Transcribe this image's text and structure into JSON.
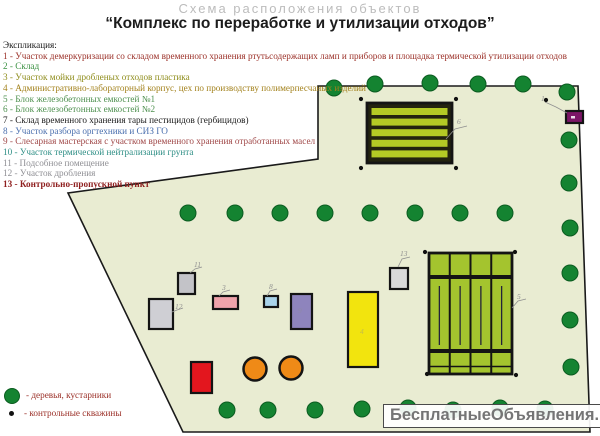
{
  "header": {
    "watermark_title": "Схема расположения объектов",
    "title": "“Комплекс по переработке и утилизации отходов”"
  },
  "legend": {
    "heading": "Экспликация:",
    "items": [
      {
        "num": "1",
        "text": "1 - Участок демеркуризации со складом временного хранения ртутьсодержащих ламп и приборов и площадка термической утилизации отходов",
        "color": "#9b3028"
      },
      {
        "num": "2",
        "text": "2 - Склад",
        "color": "#3a9142"
      },
      {
        "num": "3",
        "text": "3 - Участок мойки дробленых отходов пластика",
        "color": "#8f8d1c"
      },
      {
        "num": "4",
        "text": "4 - Административно-лабораторный корпус, цех по производству полимерпесчаных изделий",
        "color": "#a3821d"
      },
      {
        "num": "5",
        "text": "5 - Блок железобетонных емкостей №1",
        "color": "#4f9150"
      },
      {
        "num": "6",
        "text": "6 - Блок железобетонных емкостей №2",
        "color": "#4f9150"
      },
      {
        "num": "7",
        "text": "7 - Склад временного хранения тары пестицидов (гербицидов)",
        "color": "#1a1a1a"
      },
      {
        "num": "8",
        "text": "8 - Участок разбора оргтехники и СИЗ ГО",
        "color": "#4a6fae"
      },
      {
        "num": "9",
        "text": "9 - Слесарная мастерская с участком временного хранения отработанных масел",
        "color": "#a04848"
      },
      {
        "num": "10",
        "text": "10 - Участок термической нейтрализации грунта",
        "color": "#2f8f86"
      },
      {
        "num": "11",
        "text": "11 - Подсобное помещение",
        "color": "#8f8f94"
      },
      {
        "num": "12",
        "text": "12 - Участок дробления",
        "color": "#8f8f94"
      },
      {
        "num": "13",
        "text": "13 - Контрольно-пропускной пункт",
        "color": "#8f1f1f",
        "bold": true
      }
    ]
  },
  "symbols": [
    {
      "icon": "tree-icon",
      "label": "- деревья, кустарники"
    },
    {
      "icon": "well-icon",
      "label": "- контрольные скважины"
    }
  ],
  "watermark": "БесплатныеОбъявления.рф",
  "colors": {
    "site_fill": "#e9ecd2",
    "site_border": "#1a1a1a",
    "tree": "#148331",
    "tree_edge": "#0b5c20",
    "well": "#111111",
    "marker_label": "#8f8f8f"
  },
  "map": {
    "boundary": "318,86 578,86 590,432 183,432 68,193 318,159",
    "trees": [
      [
        334,
        88
      ],
      [
        375,
        84
      ],
      [
        430,
        83
      ],
      [
        478,
        84
      ],
      [
        523,
        84
      ],
      [
        567,
        92
      ],
      [
        569,
        140
      ],
      [
        569,
        183
      ],
      [
        570,
        228
      ],
      [
        570,
        273
      ],
      [
        570,
        320
      ],
      [
        571,
        367
      ],
      [
        188,
        213
      ],
      [
        235,
        213
      ],
      [
        280,
        213
      ],
      [
        325,
        213
      ],
      [
        370,
        213
      ],
      [
        415,
        213
      ],
      [
        460,
        213
      ],
      [
        505,
        213
      ],
      [
        227,
        410
      ],
      [
        268,
        410
      ],
      [
        315,
        410
      ],
      [
        362,
        409
      ],
      [
        408,
        408
      ],
      [
        453,
        410
      ],
      [
        500,
        408
      ],
      [
        545,
        409
      ]
    ],
    "wells": [
      [
        361,
        99
      ],
      [
        456,
        99
      ],
      [
        361,
        168
      ],
      [
        456,
        168
      ],
      [
        425,
        252
      ],
      [
        515,
        252
      ],
      [
        427,
        374
      ],
      [
        516,
        375
      ],
      [
        546,
        100
      ]
    ],
    "buildings": [
      {
        "id": "b6",
        "type": "striped",
        "x": 367,
        "y": 103,
        "w": 85,
        "h": 60,
        "fill": "#23230f",
        "stripe": "#b4ca25"
      },
      {
        "id": "b5",
        "type": "grid",
        "x": 429,
        "y": 253,
        "w": 83,
        "h": 121,
        "fill": "#a4c42e"
      },
      {
        "id": "b13",
        "type": "rect",
        "x": 390,
        "y": 268,
        "w": 18,
        "h": 21,
        "fill": "#d9d9d9"
      },
      {
        "id": "b4",
        "type": "rect",
        "x": 348,
        "y": 292,
        "w": 30,
        "h": 75,
        "fill": "#f2e40e"
      },
      {
        "id": "b9",
        "type": "rect",
        "x": 291,
        "y": 294,
        "w": 21,
        "h": 35,
        "fill": "#8e84bd"
      },
      {
        "id": "b8",
        "type": "rect",
        "x": 264,
        "y": 296,
        "w": 14,
        "h": 11,
        "fill": "#a9d3ea"
      },
      {
        "id": "b3",
        "type": "rect",
        "x": 213,
        "y": 296,
        "w": 25,
        "h": 13,
        "fill": "#efa3ab"
      },
      {
        "id": "b11",
        "type": "rect",
        "x": 178,
        "y": 273,
        "w": 17,
        "h": 21,
        "fill": "#c3c3c8"
      },
      {
        "id": "b12",
        "type": "rect",
        "x": 149,
        "y": 299,
        "w": 24,
        "h": 30,
        "fill": "#cfcfd4"
      },
      {
        "id": "b-red",
        "type": "rect",
        "x": 191,
        "y": 362,
        "w": 21,
        "h": 31,
        "fill": "#e3161e"
      },
      {
        "id": "b1",
        "type": "rect",
        "x": 566,
        "y": 111,
        "w": 17,
        "h": 12,
        "fill": "#7c1566"
      },
      {
        "id": "tank1",
        "type": "circle",
        "cx": 255,
        "cy": 369,
        "r": 11.5,
        "fill": "#ef8a17"
      },
      {
        "id": "tank2",
        "type": "circle",
        "cx": 291,
        "cy": 368,
        "r": 11.5,
        "fill": "#ef8a17"
      }
    ],
    "markers": [
      {
        "label": "6",
        "x": 457,
        "y": 124,
        "leader": "446,139 455,129 467,126"
      },
      {
        "label": "5",
        "x": 517,
        "y": 299,
        "leader": "512,308 518,301 526,299"
      },
      {
        "label": "13",
        "x": 400,
        "y": 256,
        "leader": "398,267 402,259 410,257"
      },
      {
        "label": "11",
        "x": 194,
        "y": 267,
        "leader": "190,273 195,269 202,267"
      },
      {
        "label": "12",
        "x": 175,
        "y": 309,
        "leader": "172,312 177,310 183,308"
      },
      {
        "label": "3",
        "x": 222,
        "y": 290,
        "leader": "219,296 223,292 230,290"
      },
      {
        "label": "8",
        "x": 269,
        "y": 289,
        "leader": "267,296 270,291 277,289"
      },
      {
        "label": "1",
        "x": 541,
        "y": 101,
        "leader": "545,102 556,107 567,113"
      },
      {
        "label": "4",
        "x": 360,
        "y": 334,
        "leader": "",
        "faint": true
      },
      {
        "label": "9",
        "x": 298,
        "y": 313,
        "leader": "",
        "faint": true
      }
    ]
  }
}
